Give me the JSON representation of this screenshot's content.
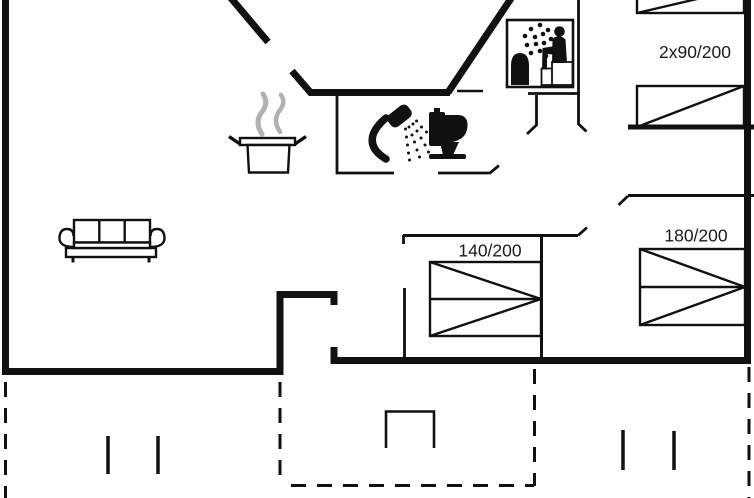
{
  "document": {
    "type": "holiday-home-floor-plan",
    "background": "#ffffff"
  },
  "colors": {
    "ink": "#111111",
    "steam_gray": "#b1b1b1",
    "label_text": "#1a1a1a"
  },
  "labels": {
    "bedroom_twin_beds": "2x90/200",
    "bedroom_double_180": "180/200",
    "bedroom_double_140": "140/200"
  },
  "icons": {
    "sofa": "sofa-icon",
    "cooking_pot": "cooking-pot-icon",
    "steam": "steam-icon",
    "shower": "shower-icon",
    "toilet": "toilet-icon",
    "sauna": "sauna-icon",
    "bed": "bed-icon",
    "door_swing": "door-swing-tick",
    "terrace_post": "terrace-post",
    "terrace_furniture": "terrace-furniture-icon"
  }
}
